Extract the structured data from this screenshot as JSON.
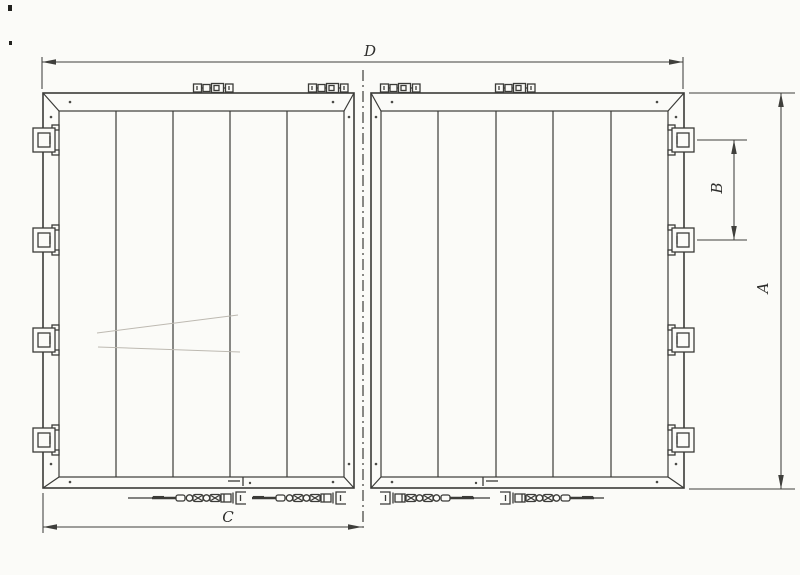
{
  "drawing": {
    "type": "technical-drawing-double-door",
    "dimension_labels": {
      "overall_width": "D",
      "overall_height": "A",
      "hinge_spacing": "B",
      "leaf_width": "C"
    },
    "colors": {
      "background": "#fbfbf8",
      "line": "#3b3b38",
      "dimension": "#3f3f3c",
      "faint": "#bdb9b1"
    }
  }
}
